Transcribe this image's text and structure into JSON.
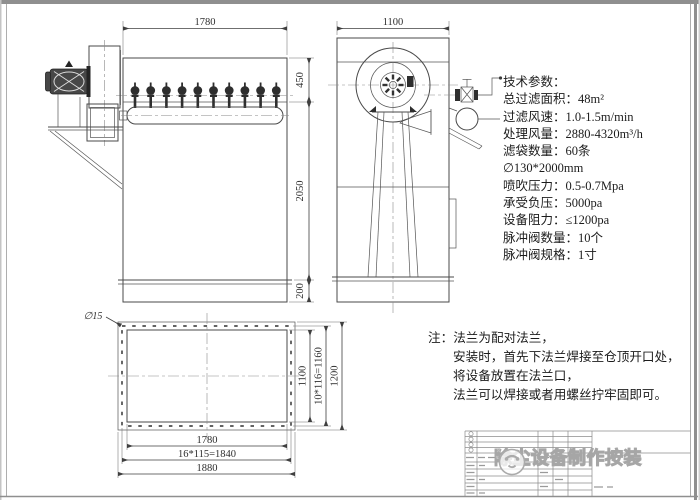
{
  "drawing": {
    "front_view": {
      "dim_width": "1780",
      "dim_height_top": "450",
      "dim_height_body": "2050",
      "dim_height_flange": "200"
    },
    "side_view": {
      "dim_width": "1100"
    },
    "plan_view": {
      "hole_diameter": "∅15",
      "dim_inner_width": "1780",
      "dim_bolt_width": "16*115=1840",
      "dim_outer_width": "1880",
      "dim_inner_height": "1100",
      "dim_bolt_height": "10*116=1160",
      "dim_outer_height": "1200"
    },
    "tech_params": {
      "lines": [
        "技术参数：",
        "总过滤面积：48m²",
        "过滤风速：1.0-1.5m/min",
        "处理风量：2880-4320m³/h",
        "滤袋数量：60条",
        "∅130*2000mm",
        "喷吹压力：0.5-0.7Mpa",
        "承受负压：5000pa",
        "设备阻力：≤1200pa",
        "脉冲阀数量：10个",
        "脉冲阀规格：1寸"
      ]
    },
    "notes": {
      "lines": [
        "注：法兰为配对法兰，",
        "安装时，首先下法兰焊接至仓顶开口处，",
        "将设备放置在法兰口，",
        "法兰可以焊接或者用螺丝拧牢固即可。"
      ]
    },
    "watermark": {
      "text": "除尘设备制作按装"
    }
  },
  "colors": {
    "line": "#4a4a4a",
    "dim_line": "#3f3f3f",
    "frame": "#8f8f8f",
    "watermark": "#a6a6a6"
  }
}
